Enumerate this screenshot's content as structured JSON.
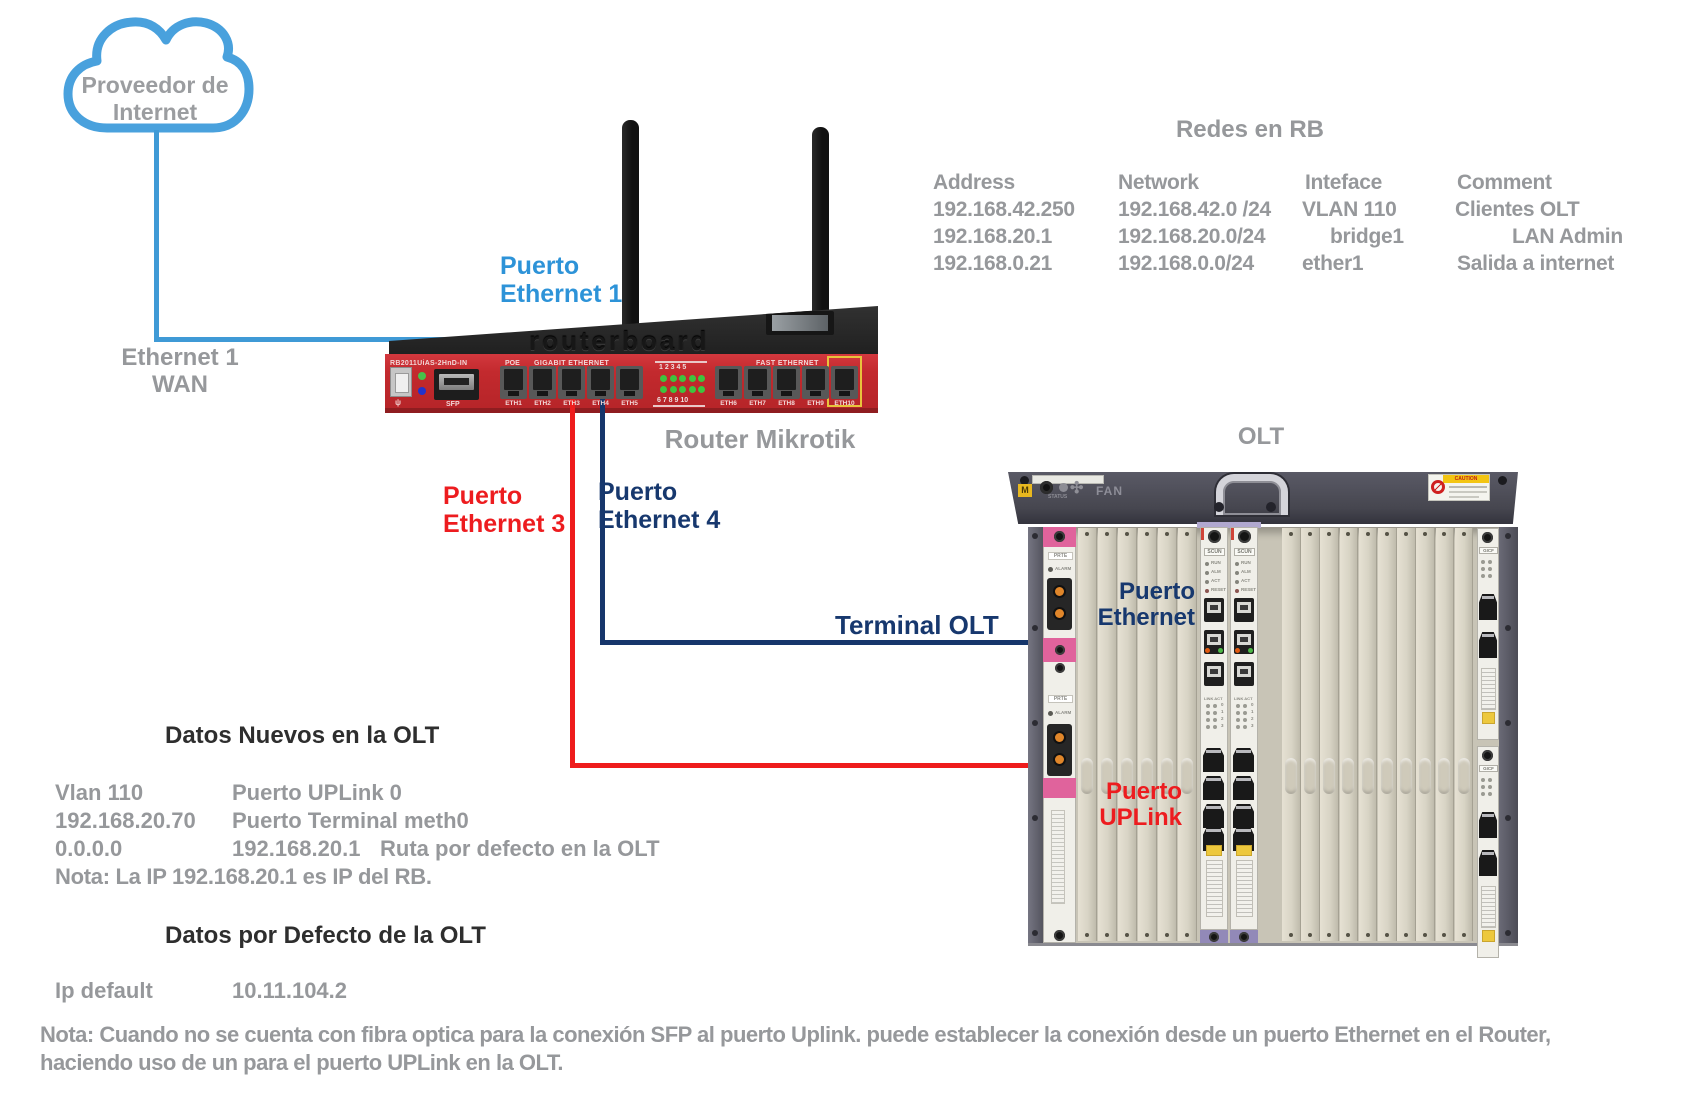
{
  "cloud": {
    "line1": "Proveedor de",
    "line2": "Internet"
  },
  "wan_label": {
    "line1": "Ethernet 1",
    "line2": "WAN"
  },
  "port1_label": {
    "line1": "Puerto",
    "line2": "Ethernet 1"
  },
  "port3_label": {
    "line1": "Puerto",
    "line2": "Ethernet 3"
  },
  "port4_label": {
    "line1": "Puerto",
    "line2": "Ethernet 4"
  },
  "terminal_olt_label": "Terminal OLT",
  "router": {
    "caption": "Router Mikrotik",
    "model": "RB2011UiAS-2HnD-IN",
    "brand_script": "MikroTik",
    "brand_embossed": "routerboard",
    "poe_label": "POE",
    "sfp_label": "SFP",
    "gigabit_label": "GIGABIT ETHERNET",
    "fast_label": "FAST ETHERNET",
    "led_numbers_top": "1  2  3  4  5",
    "led_numbers_bottom": "6  7  8  9  10",
    "gigabit_ports": [
      "ETH1",
      "ETH2",
      "ETH3",
      "ETH4",
      "ETH5"
    ],
    "fast_ports": [
      "ETH6",
      "ETH7",
      "ETH8",
      "ETH9",
      "ETH10"
    ]
  },
  "redes_table": {
    "title": "Redes en RB",
    "headers": [
      "Address",
      "Network",
      "Inteface",
      "Comment"
    ],
    "rows": [
      [
        "192.168.42.250",
        "192.168.42.0 /24",
        "VLAN 110",
        "Clientes OLT"
      ],
      [
        "192.168.20.1",
        "192.168.20.0/24",
        "bridge1",
        "LAN Admin"
      ],
      [
        "192.168.0.21",
        "192.168.0.0/24",
        "ether1",
        "Salida a internet"
      ]
    ]
  },
  "olt": {
    "caption": "OLT",
    "fan_label": "FAN",
    "status_label": "STATUS",
    "caution_label": "CAUTION",
    "scun_label": "SCUN",
    "gicf_label": "GICF",
    "prte_label": "PRTE",
    "alarm_label": "ALARM",
    "led_labels": [
      "RUN",
      "ALM",
      "ACT",
      "RESET"
    ],
    "link_act_label": "LINK ACT",
    "eth_label": {
      "line1": "Puerto",
      "line2": "Ethernet"
    },
    "uplink_label": {
      "line1": "Puerto",
      "line2": "UPLink"
    }
  },
  "datos_nuevos": {
    "title": "Datos Nuevos en  la OLT",
    "rows": [
      {
        "c1": "Vlan 110",
        "c2": "Puerto UPLink 0",
        "c3": ""
      },
      {
        "c1": "192.168.20.70",
        "c2": "Puerto Terminal meth0",
        "c3": ""
      },
      {
        "c1": "0.0.0.0",
        "c2": "192.168.20.1",
        "c3": "Ruta  por defecto en la OLT"
      }
    ],
    "nota": "Nota: La IP 192.168.20.1 es IP del RB."
  },
  "datos_defecto": {
    "title": "Datos por Defecto de la OLT",
    "row": {
      "c1": "Ip default",
      "c2": "10.11.104.2"
    }
  },
  "bottom_note": {
    "line1": "Nota: Cuando no se cuenta con fibra optica para la conexión SFP al puerto Uplink. puede establecer la conexión desde un puerto Ethernet en el Router,",
    "line2": "haciendo uso de un para el puerto UPLink en la OLT."
  },
  "colors": {
    "blue": "#2d93d8",
    "navy": "#17386e",
    "red": "#ed1c1f",
    "gray_text": "#96989b",
    "router_red": "#c32a2e",
    "olt_bar": "#4b4b57"
  }
}
